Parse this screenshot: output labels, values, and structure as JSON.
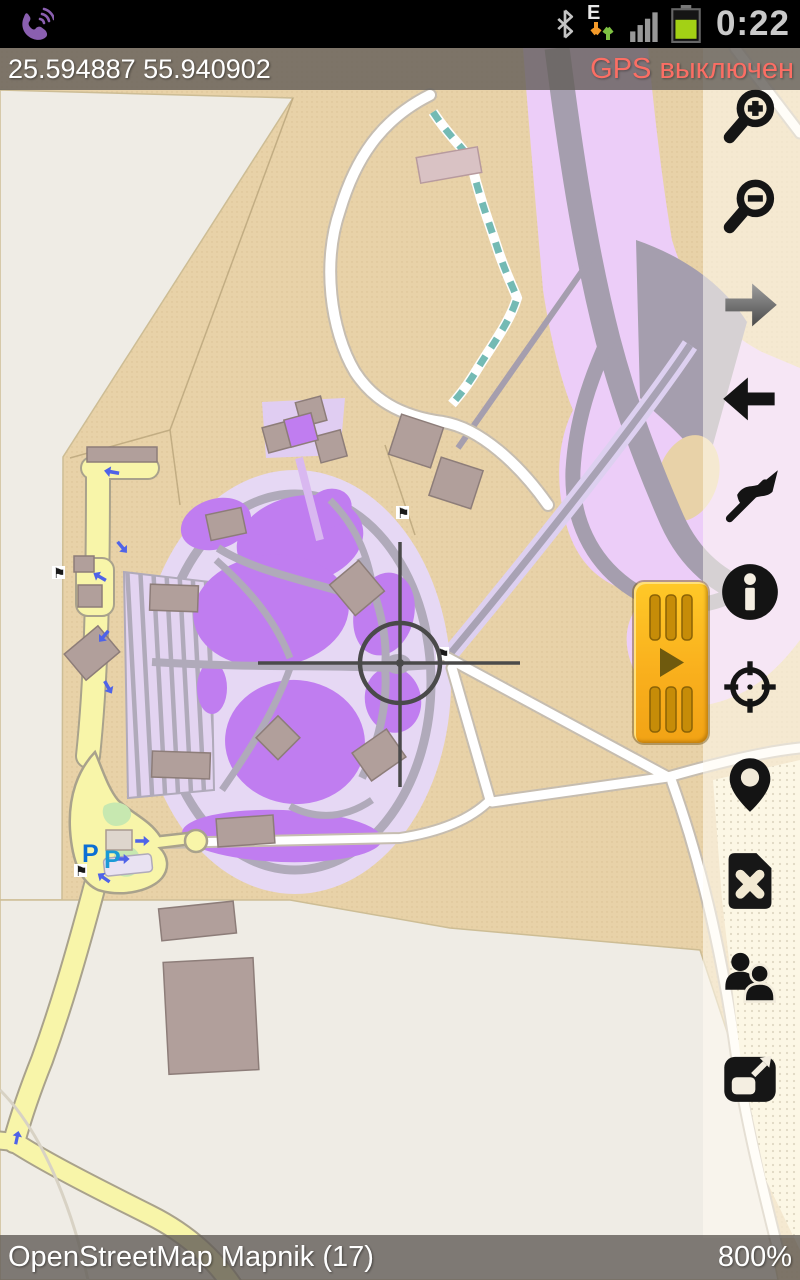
{
  "status_bar": {
    "time": "0:22",
    "network_mode": "E",
    "icons": [
      "viber-call-icon",
      "bluetooth-icon",
      "mobile-data-arrows-icon",
      "signal-strength-icon",
      "battery-icon"
    ]
  },
  "coordinate_bar": {
    "coordinates": "25.594887 55.940902",
    "gps_status": "GPS выключен",
    "gps_status_color": "#fb6e64"
  },
  "sidebar": {
    "buttons": [
      {
        "name": "zoom-in"
      },
      {
        "name": "zoom-out"
      },
      {
        "name": "redo-forward"
      },
      {
        "name": "undo-back"
      },
      {
        "name": "track-flag"
      },
      {
        "name": "info"
      },
      {
        "name": "gps-target"
      },
      {
        "name": "poi-marker"
      },
      {
        "name": "clear-track"
      },
      {
        "name": "friends"
      },
      {
        "name": "fullscreen"
      }
    ]
  },
  "track_panel": {
    "name": "track-recorder",
    "play_glyph": "▶"
  },
  "map": {
    "parking_label_1": "P",
    "parking_label_2": "P",
    "flag_glyph": "⚑",
    "colors": {
      "land_beige": "#e8d2a8",
      "land_offwhite": "#efece5",
      "apron_purple": "#eccdf8",
      "runway_gray": "#a59eae",
      "park_purple": "#c07df0",
      "park_lavender": "#e6d8f4",
      "path_gray": "#b0aaba",
      "road_yellow": "#f8f5a9",
      "road_white": "#ffffff",
      "building_brown": "#b19f9b",
      "stream_teal": "#74bab4",
      "sand_dotted": "#f8f1d5",
      "parking_blue": "#0c6fd4"
    }
  },
  "bottom_bar": {
    "map_source": "OpenStreetMap Mapnik (17)",
    "zoom_level": "800%"
  }
}
